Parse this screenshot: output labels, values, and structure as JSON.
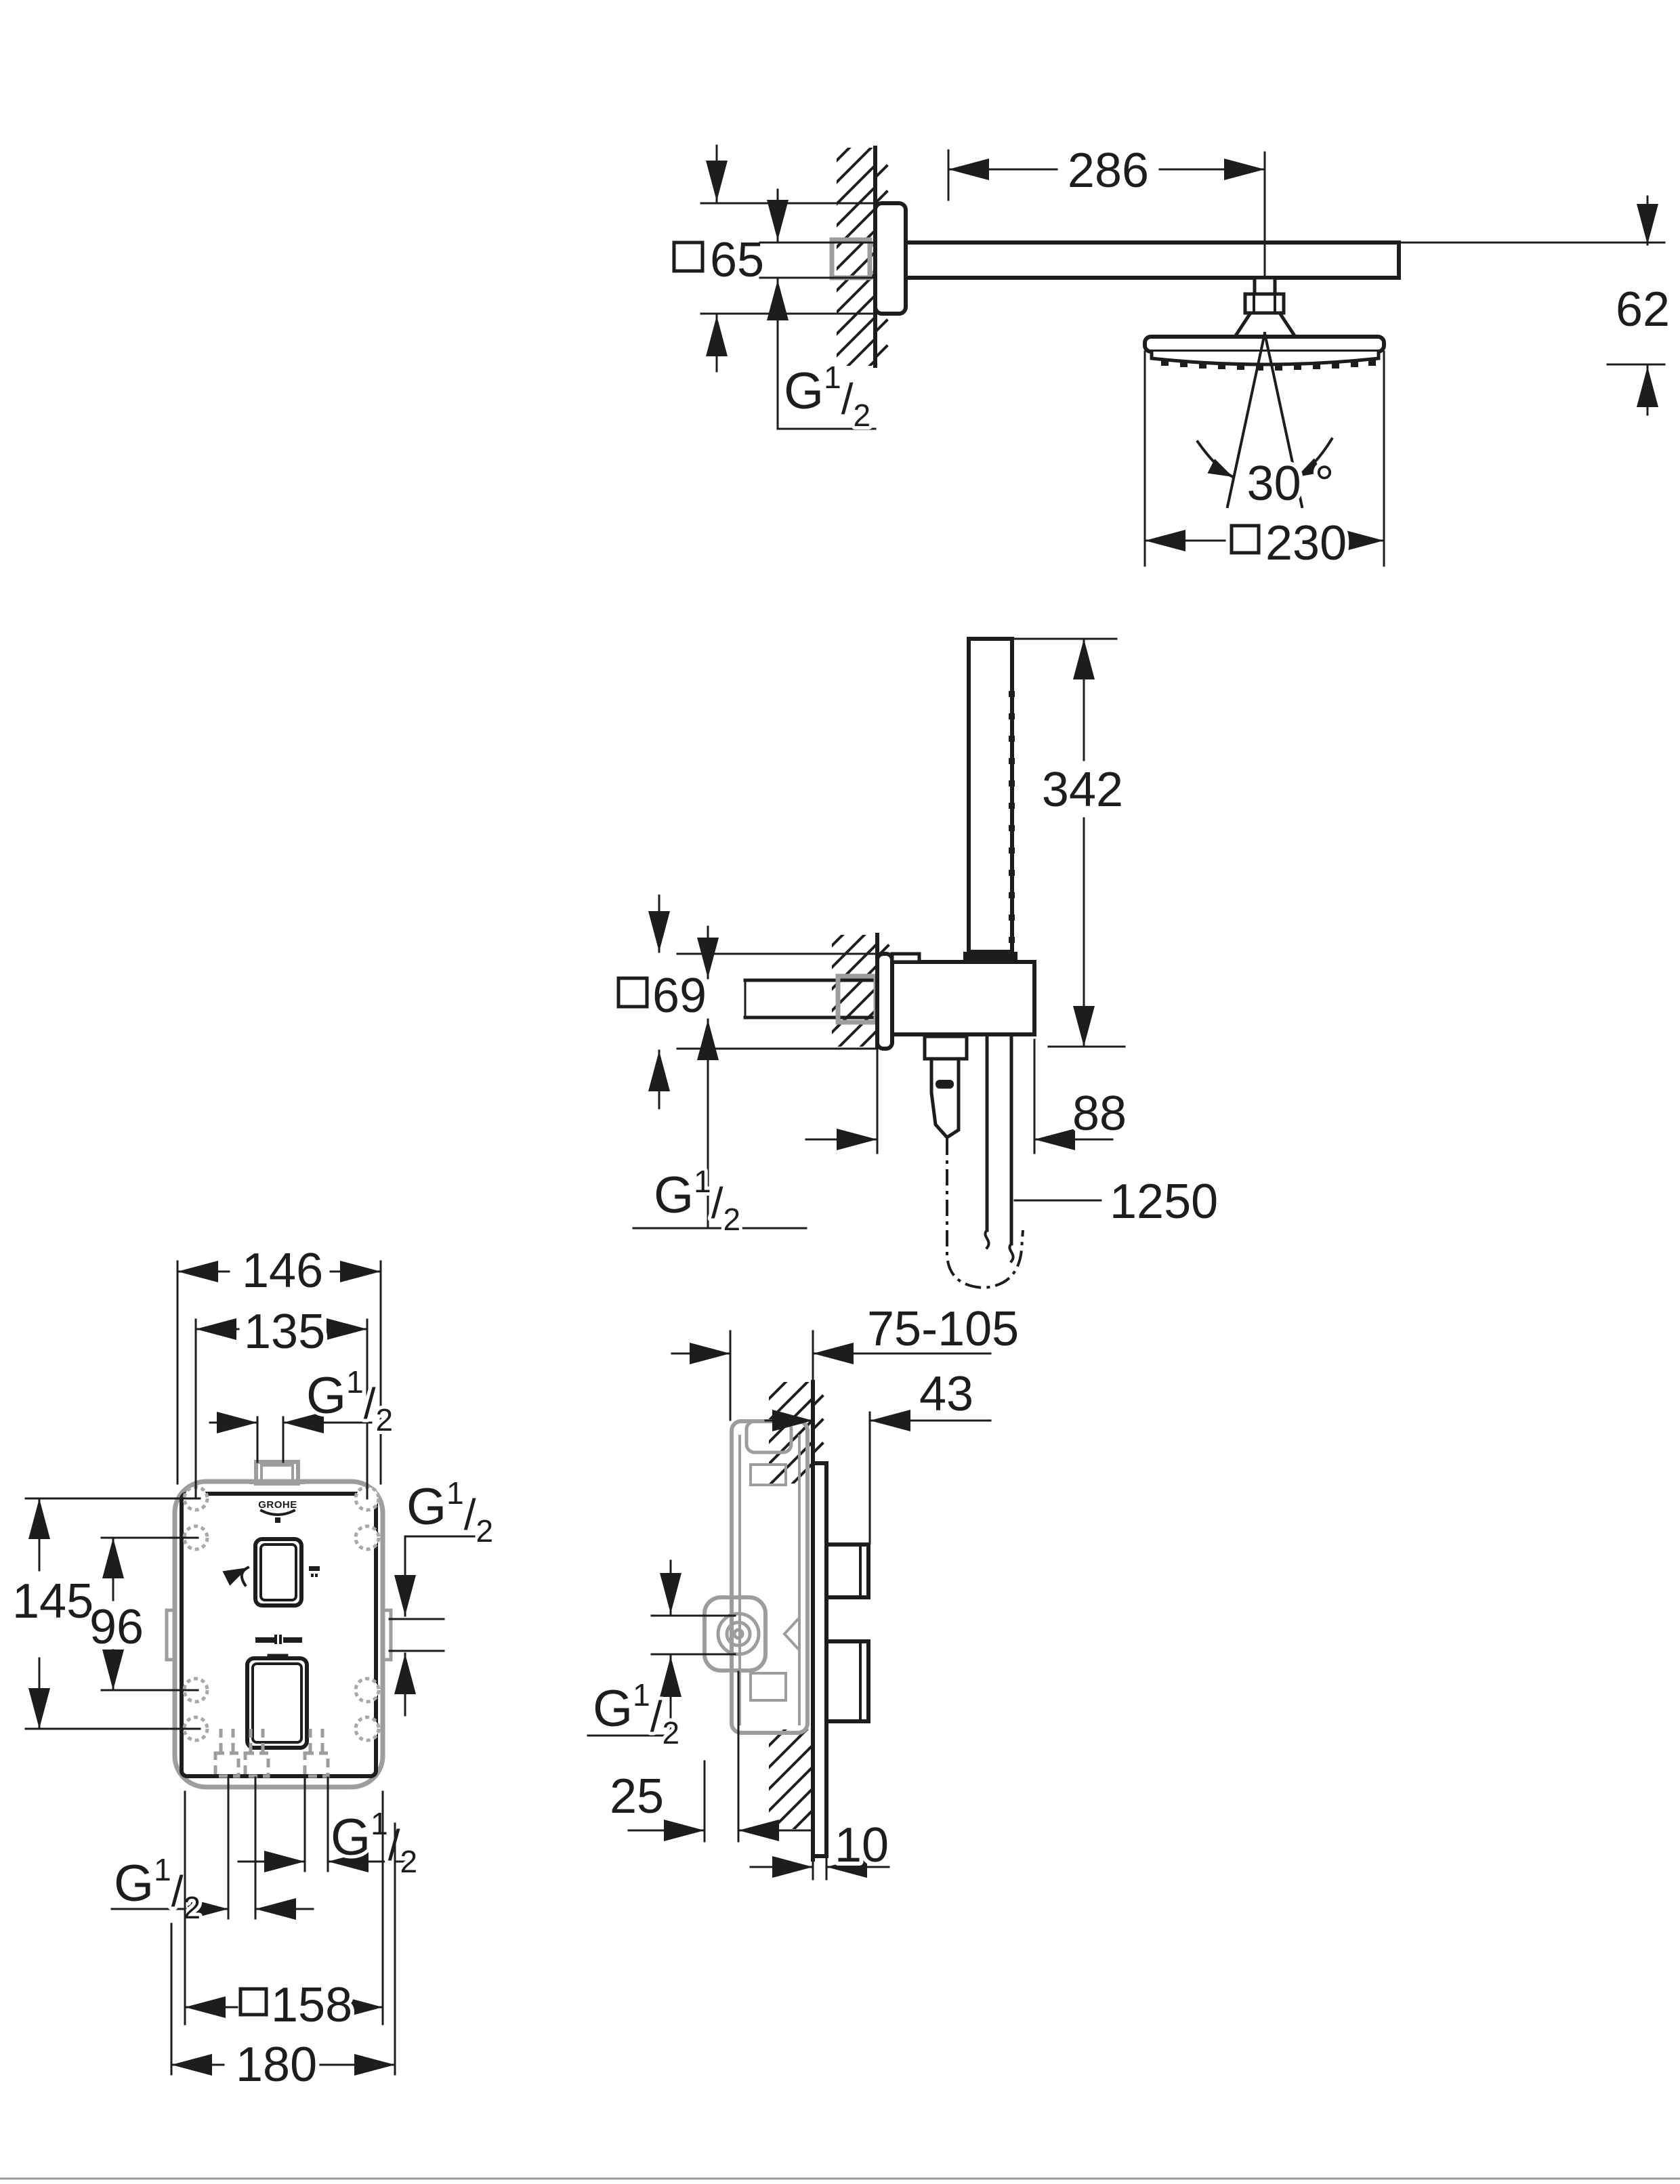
{
  "drawing": {
    "kind": "installation-dimension-drawing",
    "colors": {
      "line": "#1d1d1d",
      "secondary": "#9d9d9d",
      "background": "#ffffff"
    },
    "logo": "GROHE",
    "thread": {
      "main": "G",
      "sup": "1",
      "slash": "/",
      "sub": "2"
    },
    "dims": {
      "arm_reach": "286",
      "arm_escutcheon": "65",
      "head_drop": "62",
      "swivel_angle": "30 °",
      "head_width": "230",
      "handshower_length": "342",
      "outlet_escutcheon": "69",
      "holder_depth": "88",
      "hose_length": "1250",
      "plate_width_outer": "146",
      "ports_spacing_h": "135",
      "plate_height_outer": "145",
      "ports_spacing_v": "96",
      "plate_square": "158",
      "plate_total": "180",
      "install_depth": "75-105",
      "knob_protrusion": "43",
      "inlet_offset": "25",
      "plate_thickness": "10"
    }
  }
}
